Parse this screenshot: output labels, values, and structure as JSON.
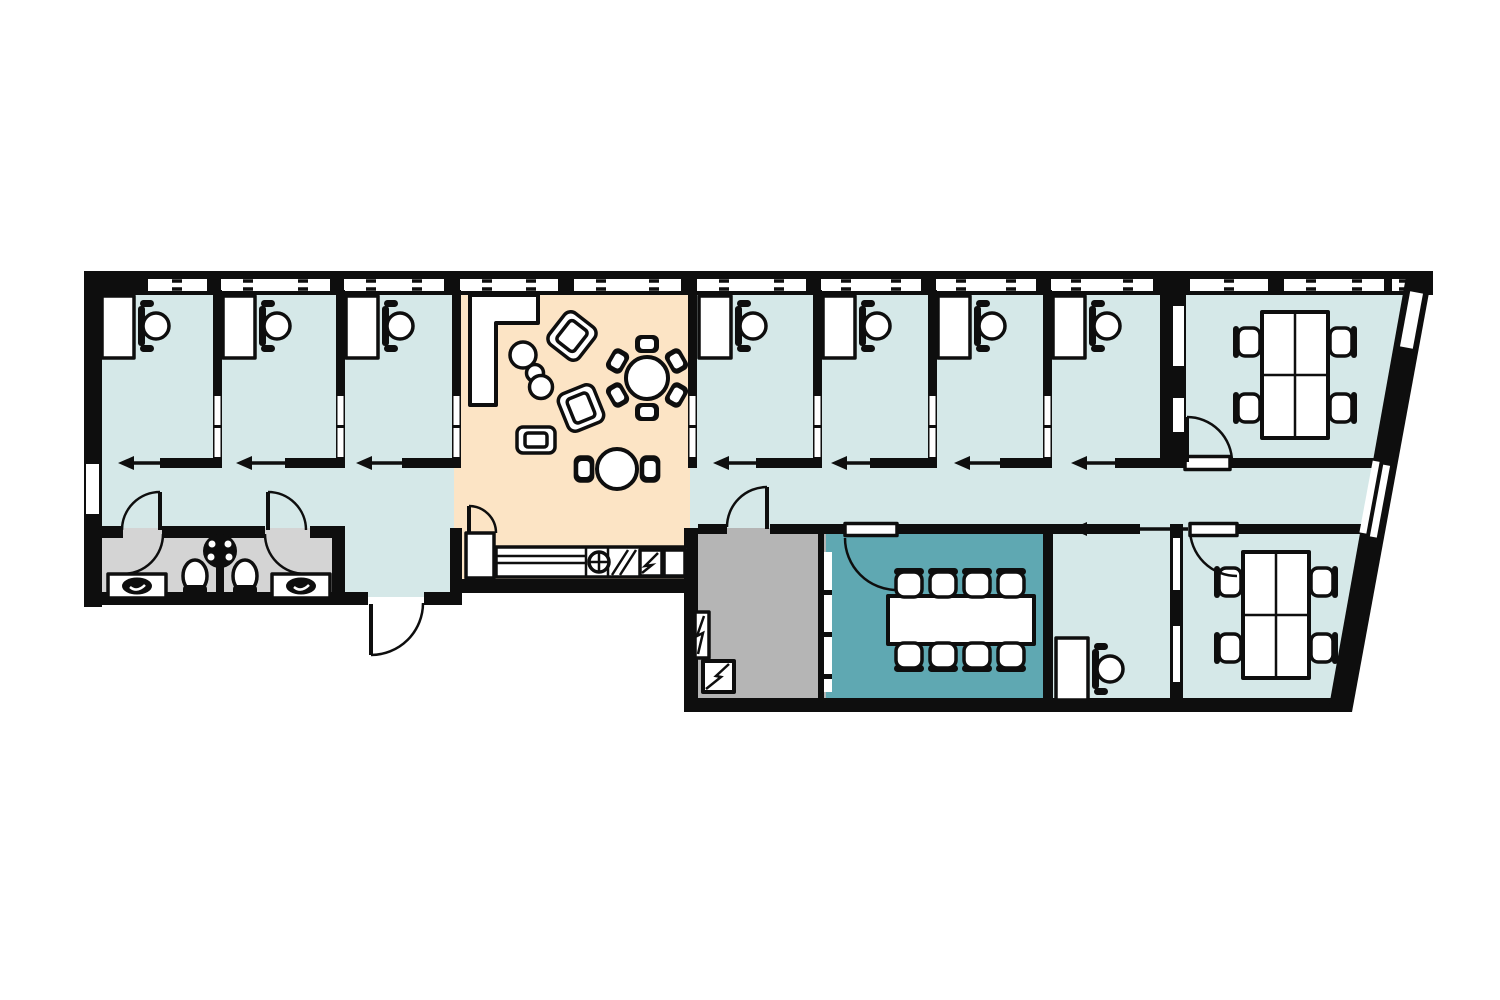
{
  "diagram": {
    "type": "floor-plan",
    "title": "Office suite floor plan",
    "text_labels_visible": false
  },
  "colors": {
    "wall": "#0e0e0e",
    "office_floor": "#d5e8e8",
    "lounge_floor": "#fce4c5",
    "meeting_floor": "#5fa8b2",
    "utility_floor": "#b5b5b5",
    "bathroom_floor": "#d4d4d4",
    "furniture": "#ffffff",
    "background": "#ffffff"
  },
  "rooms": [
    {
      "id": "office-1",
      "type": "private-office",
      "furniture": [
        "desk",
        "task-chair"
      ],
      "door": "sliding"
    },
    {
      "id": "office-2",
      "type": "private-office",
      "furniture": [
        "desk",
        "task-chair"
      ],
      "door": "sliding"
    },
    {
      "id": "office-3",
      "type": "private-office",
      "furniture": [
        "desk",
        "task-chair"
      ],
      "door": "sliding"
    },
    {
      "id": "office-4",
      "type": "private-office",
      "furniture": [
        "desk",
        "task-chair"
      ],
      "door": "sliding"
    },
    {
      "id": "office-5",
      "type": "private-office",
      "furniture": [
        "desk",
        "task-chair"
      ],
      "door": "sliding"
    },
    {
      "id": "office-6",
      "type": "private-office",
      "furniture": [
        "desk",
        "task-chair"
      ],
      "door": "sliding"
    },
    {
      "id": "office-7",
      "type": "private-office",
      "furniture": [
        "desk",
        "task-chair"
      ],
      "door": "sliding"
    },
    {
      "id": "lounge-kitchen",
      "type": "open-lounge",
      "furniture": [
        "l-shaped-sofa",
        "pouf",
        "pouf",
        "pouf",
        "tilted-lounge-chair",
        "tilted-lounge-chair",
        "armchair",
        "round-table-6-chairs",
        "round-table-2-chairs",
        "kitchen-counter-with-cooktop-and-appliances",
        "tall-cabinet"
      ],
      "door": "hinged"
    },
    {
      "id": "team-room-north",
      "type": "team-office",
      "furniture": [
        "quad-desk-cluster",
        "task-chair",
        "task-chair",
        "task-chair",
        "task-chair"
      ],
      "door": "hinged"
    },
    {
      "id": "team-room-south",
      "type": "team-office",
      "furniture": [
        "quad-desk-cluster",
        "task-chair",
        "task-chair",
        "task-chair",
        "task-chair"
      ],
      "door": "hinged"
    },
    {
      "id": "meeting-room",
      "type": "conference-room",
      "furniture": [
        "conference-table",
        "chair-x8"
      ],
      "door": "hinged",
      "glass_wall": true
    },
    {
      "id": "desk-nook",
      "type": "open-office",
      "furniture": [
        "desk",
        "task-chair"
      ],
      "door": "sliding"
    },
    {
      "id": "restroom-left",
      "type": "restroom",
      "furniture": [
        "sink-counter",
        "toilet",
        "shared-round-basin"
      ],
      "door": "hinged"
    },
    {
      "id": "restroom-right",
      "type": "restroom",
      "furniture": [
        "sink-counter",
        "toilet",
        "shared-round-basin"
      ],
      "door": "hinged"
    },
    {
      "id": "utility-room",
      "type": "utility",
      "furniture": [
        "electrical-panel",
        "water-heater"
      ],
      "door": "hinged"
    },
    {
      "id": "vestibule",
      "type": "entrance",
      "furniture": [],
      "door": "exterior-hinged"
    },
    {
      "id": "corridor",
      "type": "circulation",
      "furniture": [],
      "door": null
    }
  ],
  "features": {
    "window_band": "continuous glazing along top exterior wall with mullion ticks",
    "slanted_wall": "right exterior wall slopes inward with two slanted window strips",
    "left_wall_window": true
  }
}
